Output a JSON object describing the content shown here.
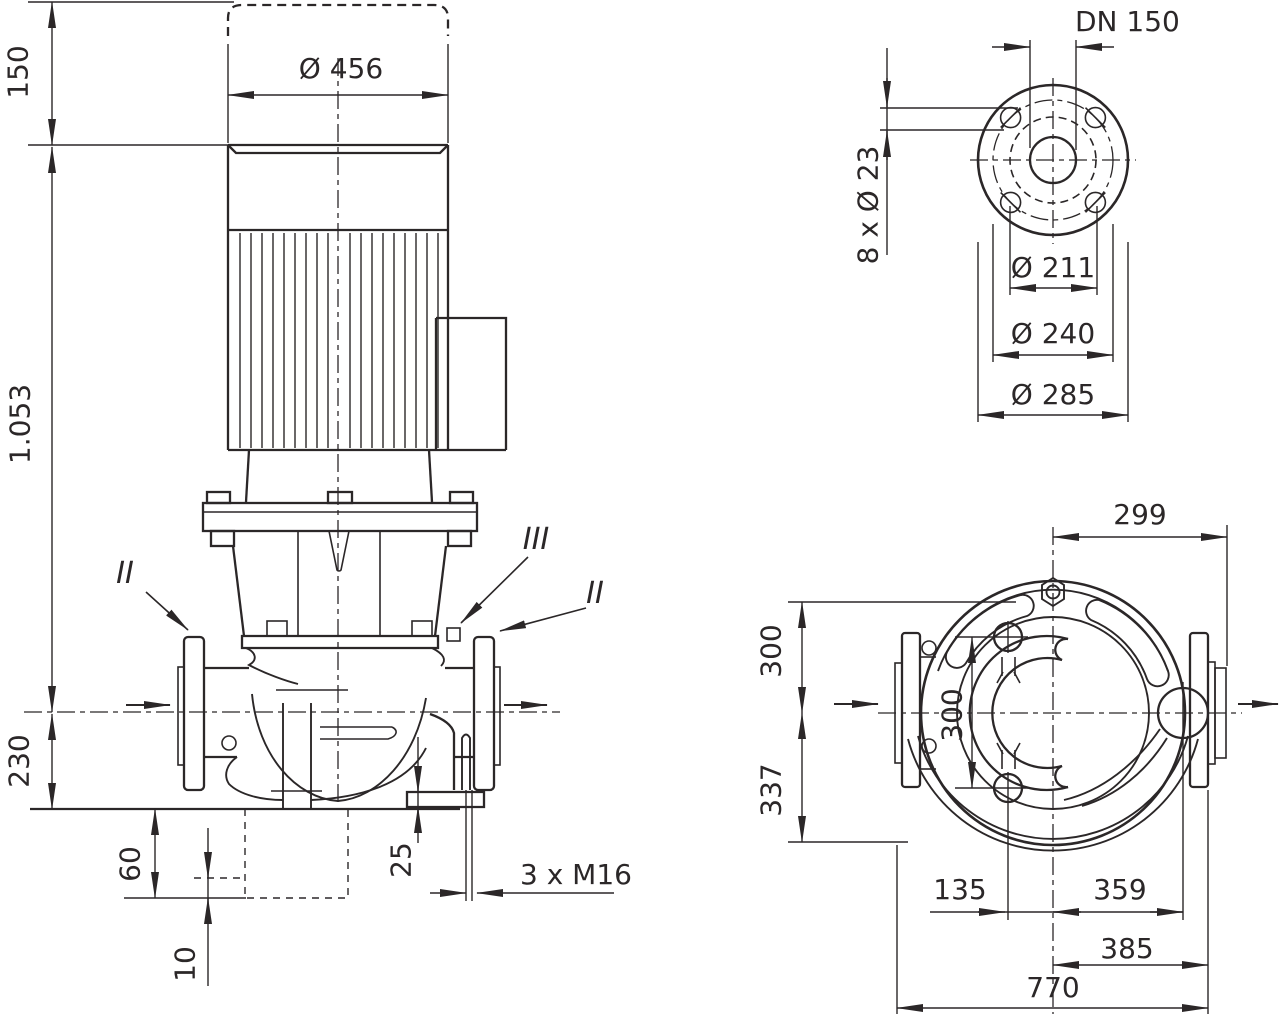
{
  "colors": {
    "background": "#ffffff",
    "line": "#2b2728"
  },
  "front": {
    "dim_150": "150",
    "dim_total": "1.053",
    "dim_230": "230",
    "dim_motor_d": "Ø 456",
    "dim_60": "60",
    "dim_10": "10",
    "dim_25": "25",
    "dim_bolts": "3 x M16",
    "mark_left": "II",
    "mark_mid": "III",
    "mark_right": "II"
  },
  "flange": {
    "dn": "DN 150",
    "holes": "8 x Ø 23",
    "d211": "Ø 211",
    "d240": "Ø 240",
    "d285": "Ø 285"
  },
  "top": {
    "dim_299": "299",
    "dim_300_left": "300",
    "dim_337": "337",
    "dim_300_ports": "300",
    "dim_135": "135",
    "dim_359": "359",
    "dim_385": "385",
    "dim_770": "770"
  }
}
